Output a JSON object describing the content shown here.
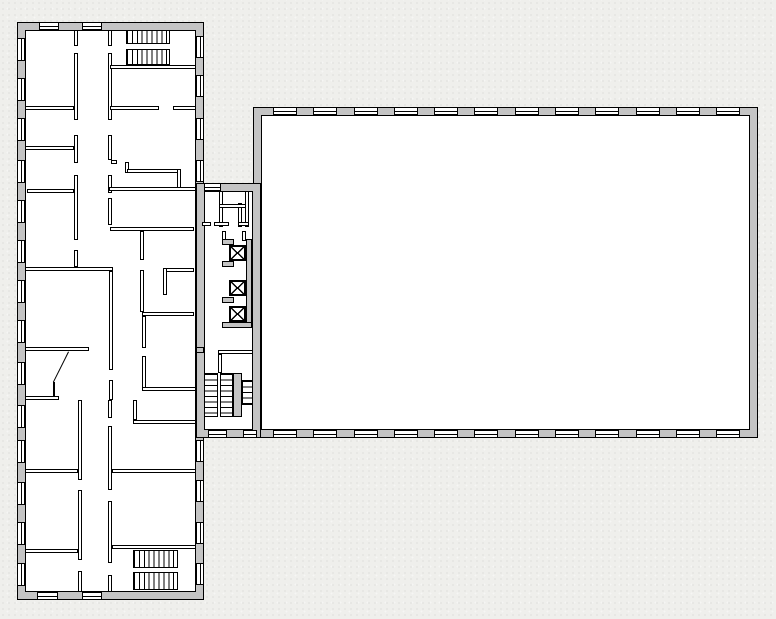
{
  "document": {
    "kind": "architectural-floor-plan",
    "visible_text": []
  },
  "colors": {
    "background": "#efefec",
    "wall_fill": "#c4c4c4",
    "line": "#000000",
    "floor": "#ffffff"
  },
  "plan": {
    "canvas": {
      "w": 776,
      "h": 619
    },
    "wings": [
      {
        "name": "left-wing",
        "outer": [
          17,
          22,
          187,
          578
        ],
        "inner": [
          25,
          30,
          171,
          562
        ]
      },
      {
        "name": "right-wing",
        "outer": [
          253,
          107,
          505,
          331
        ],
        "inner": [
          261,
          115,
          489,
          315
        ]
      },
      {
        "name": "connector",
        "outer": [
          196,
          183,
          65,
          255
        ],
        "inner": [
          204,
          191,
          49,
          239
        ]
      }
    ],
    "partitions": [
      [
        74,
        30,
        4,
        16
      ],
      [
        74,
        53,
        4,
        67
      ],
      [
        74,
        135,
        4,
        28
      ],
      [
        74,
        175,
        4,
        65
      ],
      [
        74,
        250,
        4,
        17
      ],
      [
        108,
        30,
        4,
        16
      ],
      [
        108,
        53,
        4,
        67
      ],
      [
        108,
        135,
        4,
        25
      ],
      [
        108,
        175,
        4,
        18
      ],
      [
        108,
        198,
        4,
        27
      ],
      [
        111,
        160,
        6,
        4
      ],
      [
        125,
        162,
        4,
        11
      ],
      [
        127,
        169,
        54,
        4
      ],
      [
        177,
        169,
        4,
        22
      ],
      [
        109,
        187,
        87,
        4
      ],
      [
        25,
        106,
        49,
        4
      ],
      [
        25,
        146,
        49,
        4
      ],
      [
        27,
        189,
        47,
        4
      ],
      [
        25,
        267,
        88,
        4
      ],
      [
        25,
        347,
        64,
        4
      ],
      [
        25,
        396,
        34,
        4
      ],
      [
        25,
        469,
        53,
        4
      ],
      [
        25,
        549,
        53,
        4
      ],
      [
        110,
        65,
        86,
        4
      ],
      [
        110,
        106,
        49,
        4
      ],
      [
        173,
        106,
        23,
        4
      ],
      [
        110,
        227,
        84,
        4
      ],
      [
        163,
        268,
        31,
        4
      ],
      [
        163,
        268,
        4,
        27
      ],
      [
        140,
        231,
        4,
        29
      ],
      [
        140,
        270,
        4,
        42
      ],
      [
        142,
        316,
        4,
        32
      ],
      [
        142,
        356,
        4,
        35
      ],
      [
        142,
        387,
        54,
        4
      ],
      [
        142,
        312,
        52,
        4
      ],
      [
        109,
        271,
        4,
        99
      ],
      [
        109,
        380,
        4,
        20
      ],
      [
        78,
        400,
        4,
        80
      ],
      [
        78,
        490,
        4,
        70
      ],
      [
        78,
        571,
        4,
        21
      ],
      [
        108,
        400,
        4,
        18
      ],
      [
        108,
        426,
        4,
        64
      ],
      [
        108,
        501,
        4,
        62
      ],
      [
        108,
        575,
        4,
        17
      ],
      [
        133,
        400,
        4,
        20
      ],
      [
        133,
        420,
        63,
        4
      ],
      [
        112,
        469,
        84,
        4
      ],
      [
        112,
        545,
        84,
        4
      ],
      [
        218,
        350,
        35,
        4
      ],
      [
        218,
        354,
        4,
        19
      ],
      [
        219,
        191,
        4,
        36
      ],
      [
        238,
        203,
        4,
        24
      ],
      [
        219,
        204,
        30,
        4
      ],
      [
        245,
        191,
        4,
        36
      ],
      [
        214,
        222,
        15,
        4
      ],
      [
        238,
        222,
        11,
        4
      ],
      [
        202,
        222,
        9,
        4
      ],
      [
        222,
        231,
        4,
        10
      ],
      [
        242,
        231,
        4,
        10
      ],
      [
        53,
        382,
        2,
        14
      ]
    ],
    "gray_walls": [
      [
        196,
        347,
        8,
        6
      ],
      [
        233,
        373,
        9,
        44
      ],
      [
        246,
        239,
        6,
        89
      ],
      [
        222,
        322,
        30,
        6
      ],
      [
        222,
        239,
        12,
        6
      ],
      [
        222,
        261,
        12,
        6
      ],
      [
        222,
        297,
        12,
        6
      ]
    ],
    "elevator_cars": [
      [
        229,
        245,
        17,
        16
      ],
      [
        229,
        280,
        17,
        16
      ],
      [
        229,
        306,
        17,
        16
      ]
    ],
    "stairs_vertical_treads": [
      [
        126,
        30,
        44,
        14
      ],
      [
        126,
        49,
        44,
        16
      ],
      [
        133,
        550,
        45,
        18
      ],
      [
        133,
        572,
        45,
        18
      ]
    ],
    "stairs_horizontal_treads": [
      [
        204,
        373,
        14,
        44
      ],
      [
        220,
        373,
        13,
        44
      ],
      [
        242,
        380,
        11,
        25
      ]
    ],
    "windows_horizontal": [
      [
        39,
        22,
        20,
        8
      ],
      [
        82,
        22,
        20,
        8
      ],
      [
        37,
        592,
        21,
        8
      ],
      [
        82,
        592,
        20,
        8
      ],
      [
        204,
        183,
        17,
        8
      ],
      [
        208,
        430,
        19,
        8
      ],
      [
        243,
        430,
        14,
        8
      ],
      [
        273,
        107,
        24,
        8
      ],
      [
        313,
        107,
        24,
        8
      ],
      [
        354,
        107,
        24,
        8
      ],
      [
        394,
        107,
        24,
        8
      ],
      [
        434,
        107,
        24,
        8
      ],
      [
        474,
        107,
        24,
        8
      ],
      [
        515,
        107,
        24,
        8
      ],
      [
        555,
        107,
        24,
        8
      ],
      [
        595,
        107,
        24,
        8
      ],
      [
        636,
        107,
        24,
        8
      ],
      [
        676,
        107,
        24,
        8
      ],
      [
        716,
        107,
        24,
        8
      ],
      [
        273,
        430,
        24,
        8
      ],
      [
        313,
        430,
        24,
        8
      ],
      [
        354,
        430,
        24,
        8
      ],
      [
        394,
        430,
        24,
        8
      ],
      [
        434,
        430,
        24,
        8
      ],
      [
        474,
        430,
        24,
        8
      ],
      [
        515,
        430,
        24,
        8
      ],
      [
        555,
        430,
        24,
        8
      ],
      [
        595,
        430,
        24,
        8
      ],
      [
        636,
        430,
        24,
        8
      ],
      [
        676,
        430,
        24,
        8
      ],
      [
        716,
        430,
        24,
        8
      ]
    ],
    "windows_vertical": [
      [
        17,
        38,
        8,
        23
      ],
      [
        17,
        78,
        8,
        23
      ],
      [
        17,
        118,
        8,
        23
      ],
      [
        17,
        160,
        8,
        23
      ],
      [
        17,
        200,
        8,
        23
      ],
      [
        17,
        240,
        8,
        23
      ],
      [
        17,
        280,
        8,
        23
      ],
      [
        17,
        320,
        8,
        23
      ],
      [
        17,
        362,
        8,
        23
      ],
      [
        17,
        405,
        8,
        23
      ],
      [
        17,
        440,
        8,
        23
      ],
      [
        17,
        482,
        8,
        23
      ],
      [
        17,
        522,
        8,
        23
      ],
      [
        17,
        563,
        8,
        23
      ],
      [
        196,
        36,
        8,
        22
      ],
      [
        196,
        75,
        8,
        22
      ],
      [
        196,
        118,
        8,
        22
      ],
      [
        196,
        160,
        8,
        22
      ],
      [
        196,
        440,
        8,
        22
      ],
      [
        196,
        480,
        8,
        22
      ],
      [
        196,
        522,
        8,
        22
      ],
      [
        196,
        563,
        8,
        22
      ]
    ],
    "door_swing": {
      "x": 69,
      "y": 352,
      "length": 33.5,
      "angle_deg": 116.6
    }
  }
}
